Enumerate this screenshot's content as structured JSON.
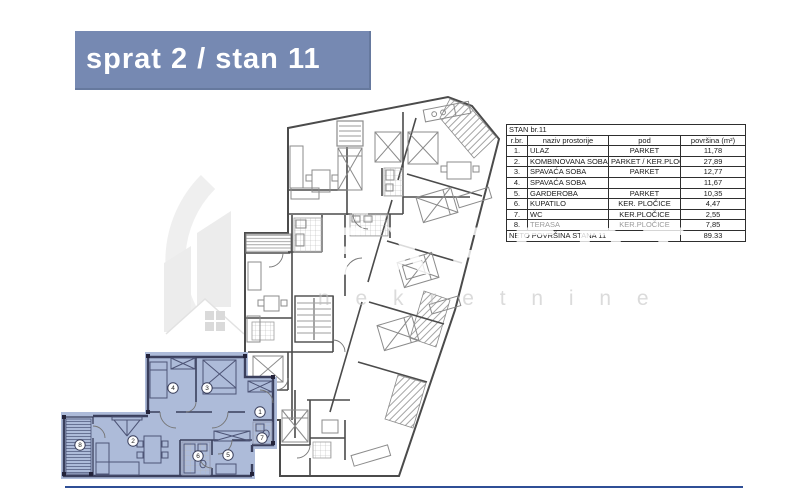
{
  "banner": {
    "title": "sprat 2 / stan 11"
  },
  "watermark": {
    "brand": "EXPERT",
    "sub": "n e k r e t n i n e"
  },
  "table": {
    "title": "STAN br.11",
    "headers": [
      "r.br.",
      "naziv prostorije",
      "pod",
      "površina (m²)"
    ],
    "rows": [
      {
        "num": "1.",
        "name": "ULAZ",
        "floor": "PARKET",
        "area": "11,78",
        "muted": false
      },
      {
        "num": "2.",
        "name": "KOMBINOVANA SOBA",
        "floor": "PARKET / KER.PLOČ",
        "area": "27,89",
        "muted": false
      },
      {
        "num": "3.",
        "name": "SPAVAĆA SOBA",
        "floor": "PARKET",
        "area": "12,77",
        "muted": false
      },
      {
        "num": "4.",
        "name": "SPAVAĆA SOBA",
        "floor": "",
        "area": "11,67",
        "muted": false
      },
      {
        "num": "5.",
        "name": "GARDEROBA",
        "floor": "PARKET",
        "area": "10,35",
        "muted": false
      },
      {
        "num": "6.",
        "name": "KUPATILO",
        "floor": "KER. PLOČICE",
        "area": "4,47",
        "muted": false
      },
      {
        "num": "7.",
        "name": "WC",
        "floor": "KER.PLOČICE",
        "area": "2,55",
        "muted": false
      },
      {
        "num": "8.",
        "name": "TERASA",
        "floor": "KER.PLOČICE",
        "area": "7,85",
        "muted": true
      }
    ],
    "total_label": "NETO POVRŠINA STANA 11",
    "total_value": "89.33"
  },
  "floorplan": {
    "highlighted_unit": "stan 11",
    "highlight_color": "#adbbd9",
    "rooms": [
      {
        "n": "1",
        "x": 260,
        "y": 412
      },
      {
        "n": "2",
        "x": 133,
        "y": 441
      },
      {
        "n": "3",
        "x": 207,
        "y": 388
      },
      {
        "n": "4",
        "x": 173,
        "y": 388
      },
      {
        "n": "5",
        "x": 228,
        "y": 455
      },
      {
        "n": "6",
        "x": 198,
        "y": 456
      },
      {
        "n": "7",
        "x": 262,
        "y": 438
      },
      {
        "n": "8",
        "x": 80,
        "y": 445
      }
    ]
  },
  "colors": {
    "banner": "#7689b2",
    "bottom_rule": "#2f4f96",
    "highlight": "#adbbd9"
  }
}
